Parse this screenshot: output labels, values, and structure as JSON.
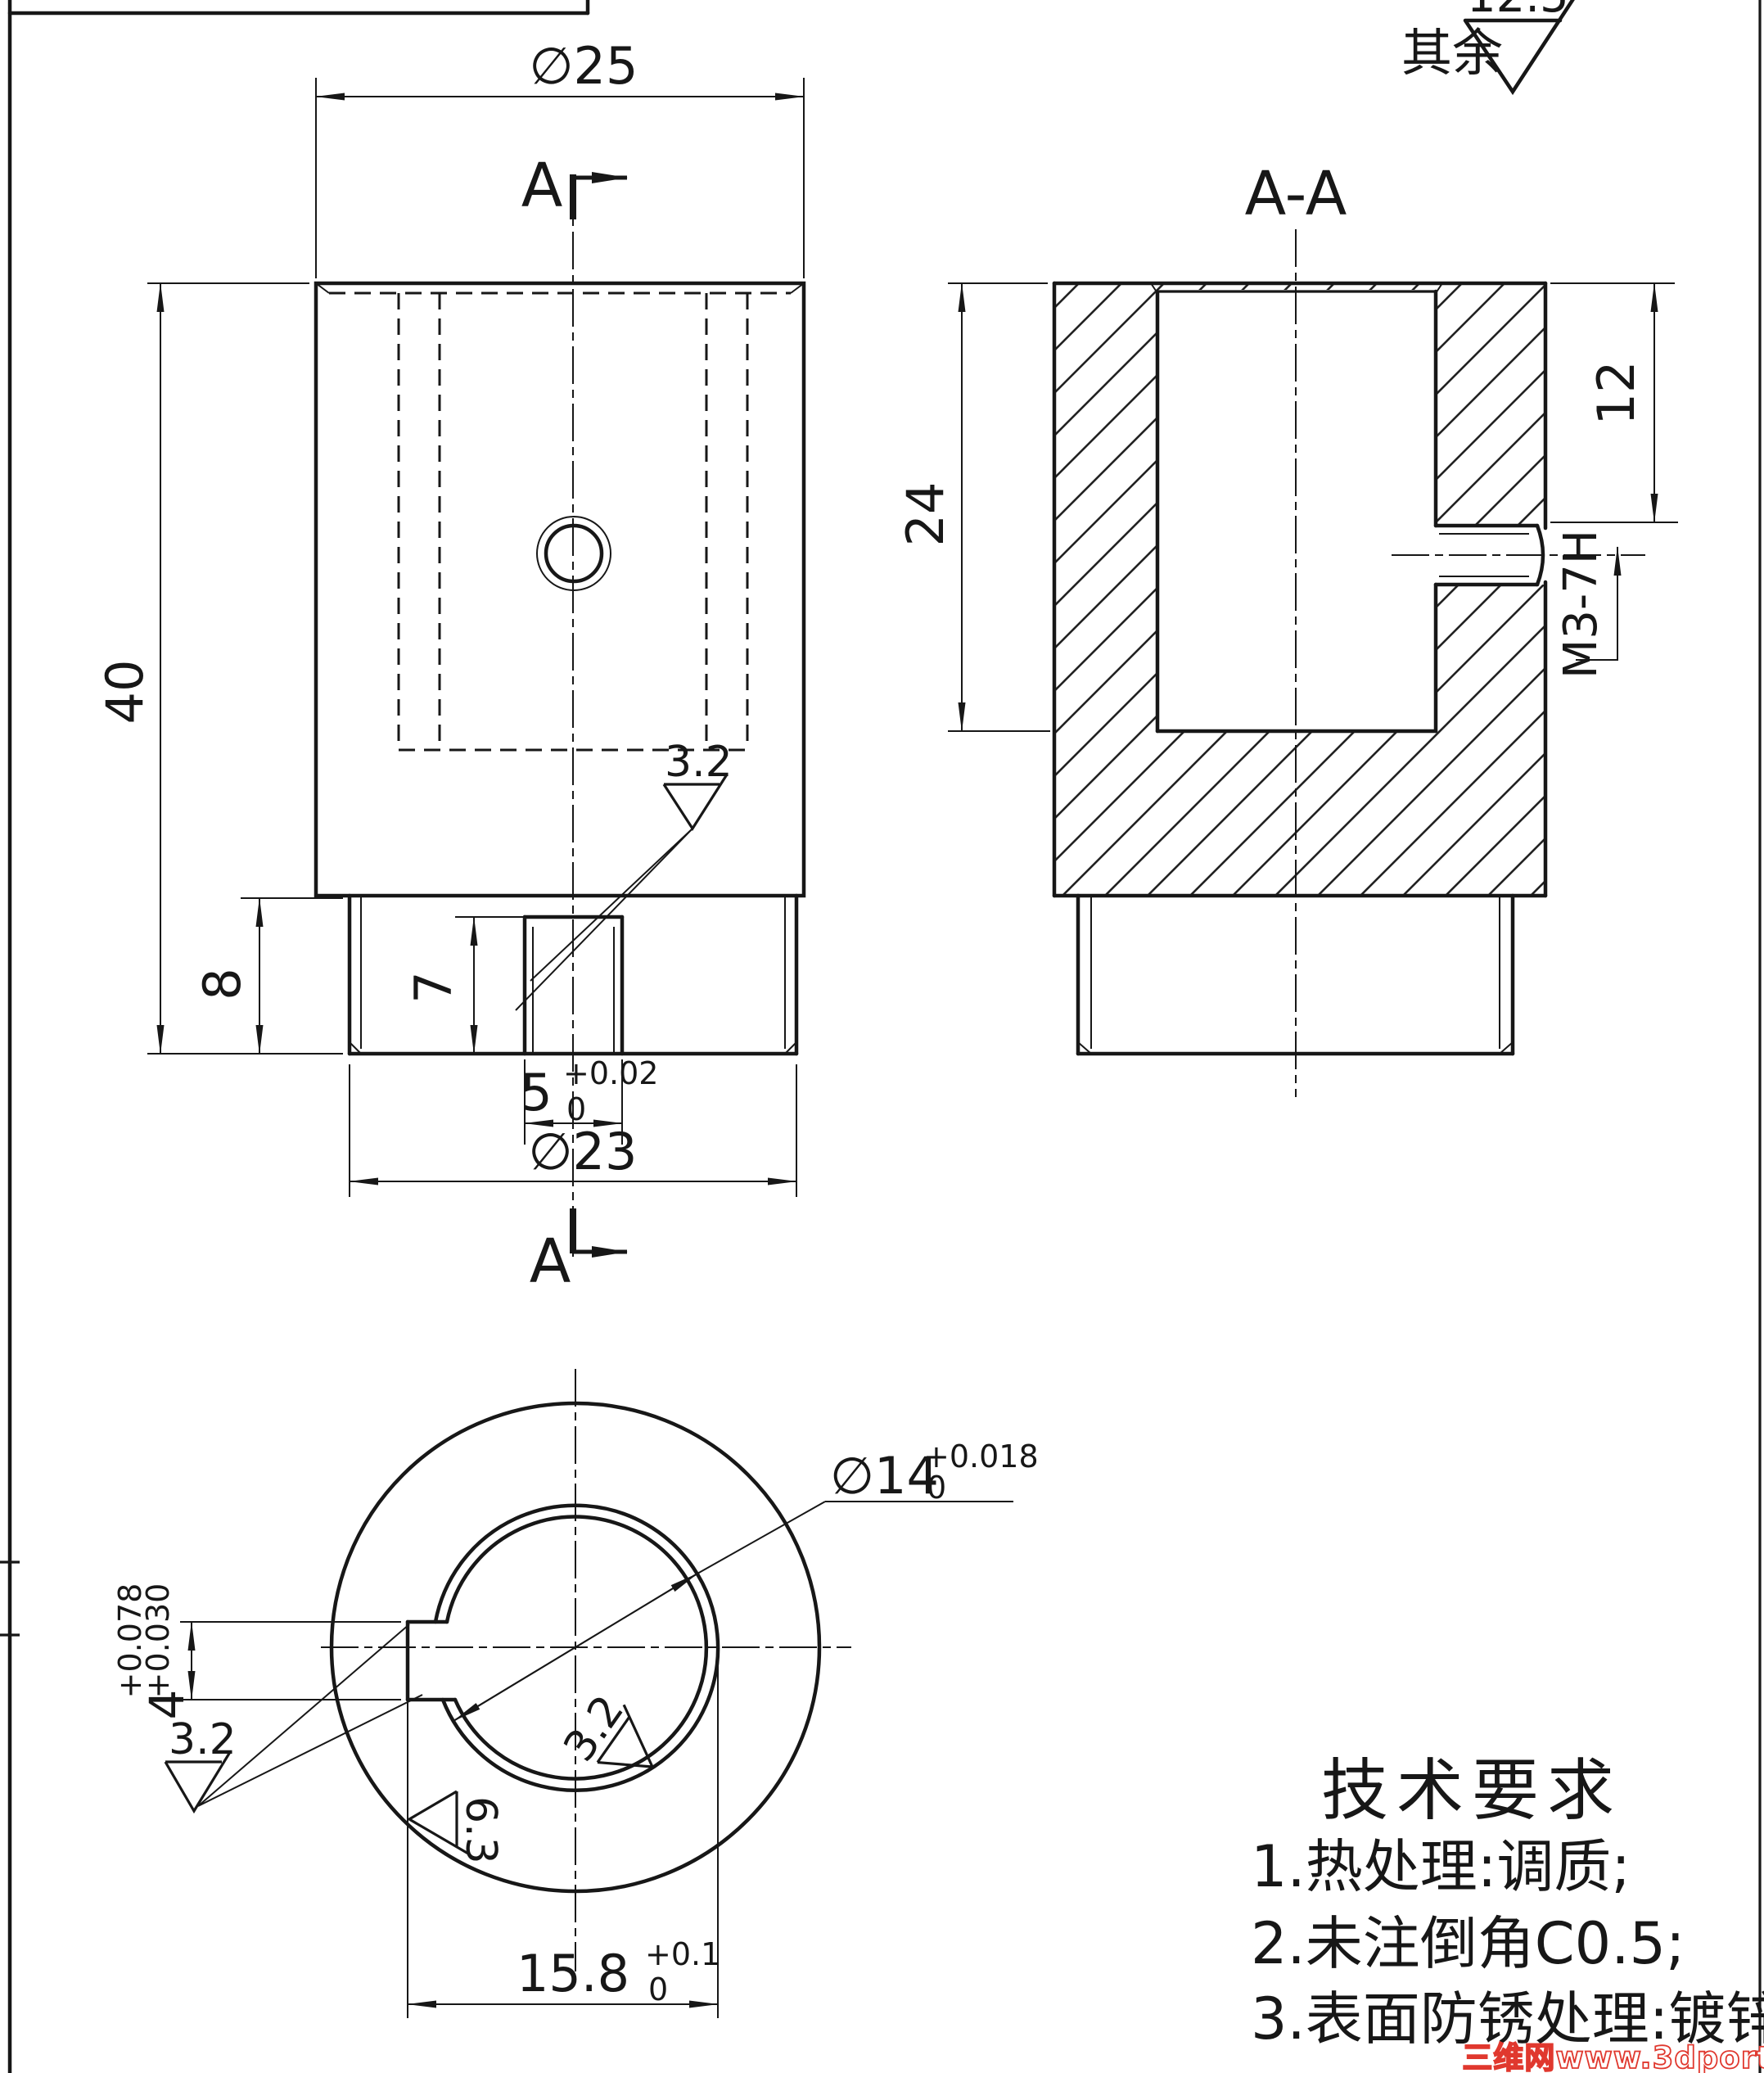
{
  "surface_default": {
    "prefix": "其余",
    "value": "12.5"
  },
  "views": {
    "front": {
      "dia25": "∅25",
      "dim40": "40",
      "dim8": "8",
      "dim7": "7",
      "dim5": "5",
      "dim5_tol_upper": "+0.02",
      "dim5_tol_lower": "0",
      "dia23": "∅23",
      "section_letter_top": "A",
      "section_letter_bottom": "A",
      "roughness": "3.2"
    },
    "section": {
      "title": "A-A",
      "dim24": "24",
      "dim12": "12",
      "thread": "M3-7H"
    },
    "bottom": {
      "dia14": "∅14",
      "dia14_tol_upper": "+0.018",
      "dia14_tol_lower": "0",
      "dim4": "4",
      "dim4_tol_upper": "+0.078",
      "dim4_tol_lower": "+0.030",
      "dim158": "15.8",
      "dim158_tol_upper": "+0.1",
      "dim158_tol_lower": "0",
      "roughness_keyway": "3.2",
      "roughness_outer": "6.3",
      "roughness_bore": "3.2"
    }
  },
  "tech_requirements": {
    "title": "技术要求",
    "items": [
      "1.热处理:调质;",
      "2.未注倒角C0.5;",
      "3.表面防锈处理:镀锌。"
    ]
  },
  "watermark": "三维网www.3dportal.cn"
}
